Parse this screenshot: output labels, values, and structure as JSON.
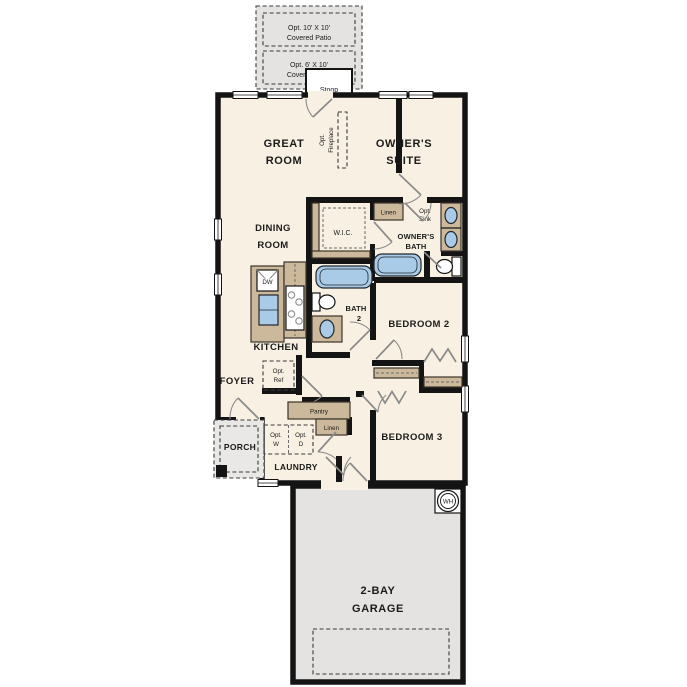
{
  "plan": {
    "colors": {
      "wall": "#141414",
      "floor": "#f8f0e3",
      "casework_tan": "#ccb99b",
      "area_gray": "#e4e3e1",
      "fixture_blue": "#a9cbe8",
      "door_gray": "#8a8a8a",
      "background": "#ffffff"
    },
    "labels": {
      "patio10": {
        "line1": "Opt. 10' X 10'",
        "line2": "Covered Patio"
      },
      "patio6": {
        "line1": "Opt. 6' X 10'",
        "line2": "Covered Patio"
      },
      "stoop": "Stoop",
      "great_room": {
        "line1": "GREAT",
        "line2": "ROOM"
      },
      "owners_suite": {
        "line1": "OWNER'S",
        "line2": "SUITE"
      },
      "opt_fireplace": {
        "line1": "Opt.",
        "line2": "Fireplace"
      },
      "wic": "W.I.C.",
      "linen_owner": "Linen",
      "opt_sink": {
        "line1": "Opt.",
        "line2": "Sink"
      },
      "owners_bath": {
        "line1": "OWNER'S",
        "line2": "BATH"
      },
      "dining_room": {
        "line1": "DINING",
        "line2": "ROOM"
      },
      "kitchen": "KITCHEN",
      "dw": "DW",
      "bath2": {
        "line1": "BATH",
        "line2": "2"
      },
      "bedroom2": "BEDROOM 2",
      "bedroom3": "BEDROOM 3",
      "foyer": "FOYER",
      "opt_ref": {
        "line1": "Opt.",
        "line2": "Ref"
      },
      "pantry": "Pantry",
      "porch": "PORCH",
      "opt_w": {
        "line1": "Opt.",
        "line2": "W"
      },
      "opt_d": {
        "line1": "Opt.",
        "line2": "D"
      },
      "linen_hall": "Linen",
      "laundry": "LAUNDRY",
      "garage": {
        "line1": "2-BAY",
        "line2": "GARAGE"
      },
      "water_heater": "WH"
    }
  }
}
